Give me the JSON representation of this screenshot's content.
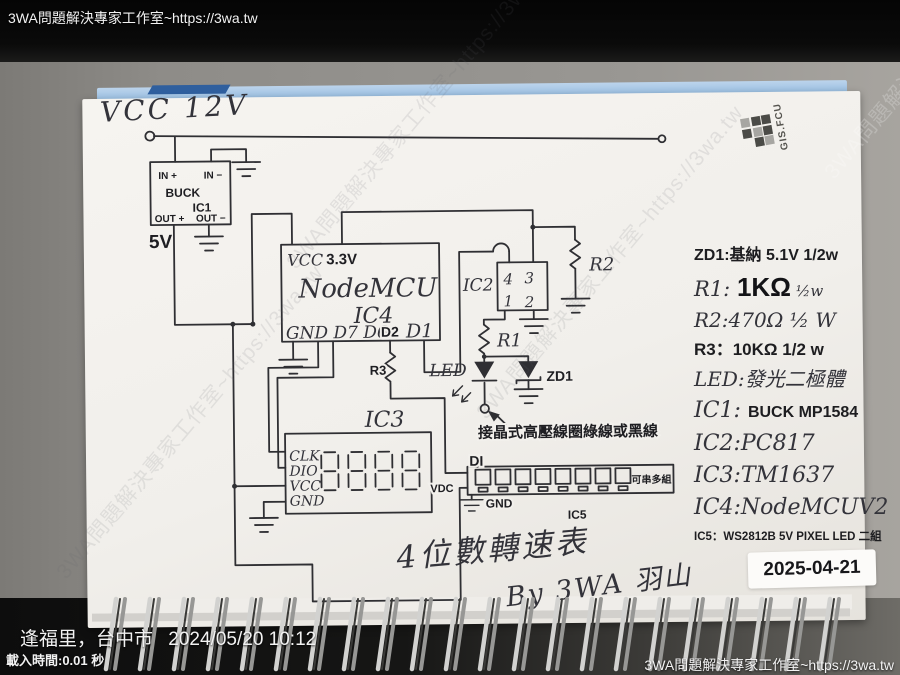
{
  "overlay": {
    "top_left": "3WA問題解決專家工作室~https://3wa.tw",
    "watermark": "3WA問題解決專家工作室~https://3wa.tw",
    "location": "逢福里，台中市",
    "datetime": "2024/05/20 10:12",
    "load_time": "載入時間:0.01 秒",
    "bottom_right": "3WA問題解決專家工作室~https://3wa.tw"
  },
  "page": {
    "logo_text": "GIS.FCU",
    "title": "4位數轉速表",
    "byline": "By 3WA 羽山",
    "date_label": "2025-04-21"
  },
  "schematic": {
    "vcc12_label": "VCC 12V",
    "v5_label": "5V",
    "ic1": {
      "in_p": "IN +",
      "in_m": "IN −",
      "name": "BUCK",
      "ref": "IC1",
      "out_p": "OUT +",
      "out_m": "OUT −"
    },
    "ic4": {
      "vcc": "VCC",
      "v33": "3.3V",
      "name": "NodeMCU",
      "ref": "IC4",
      "gnd_row": "GND D7 D6",
      "d2": "D2",
      "d1": "D1"
    },
    "ic2": {
      "ref": "IC2",
      "p4": "4",
      "p3": "3",
      "p1": "1",
      "p2": "2"
    },
    "r1": "R1",
    "r2": "R2",
    "r3": "R3",
    "led_label": "LED",
    "zd1_label": "ZD1",
    "coil_note": "接晶式高壓線圈綠線或黑線",
    "ic3": {
      "ref": "IC3",
      "pin_clk": "CLK",
      "pin_dio": "DIO",
      "pin_vcc": "VCC",
      "pin_gnd": "GND"
    },
    "ic5": {
      "di": "DI",
      "vdc": "VDC",
      "gnd": "GND",
      "ref": "IC5",
      "chain_note": "可串多組",
      "led_count": 8
    }
  },
  "notes": [
    {
      "segments": [
        {
          "t": "ZD1:基納 5.1V 1/2w",
          "s": "print16"
        }
      ]
    },
    {
      "segments": [
        {
          "t": "R1: ",
          "s": "hand21"
        },
        {
          "t": "1KΩ",
          "s": "big"
        },
        {
          "t": " ½w",
          "s": "hand15"
        }
      ]
    },
    {
      "segments": [
        {
          "t": "R2:470Ω ½ W",
          "s": "hand20"
        }
      ]
    },
    {
      "segments": [
        {
          "t": "R3：10KΩ 1/2 w",
          "s": "print17"
        }
      ]
    },
    {
      "segments": [
        {
          "t": "LED:發光二極體",
          "s": "hand20"
        }
      ]
    },
    {
      "segments": [
        {
          "t": "IC1: ",
          "s": "hand22"
        },
        {
          "t": "BUCK MP1584",
          "s": "print16"
        }
      ]
    },
    {
      "segments": [
        {
          "t": "IC2:PC817",
          "s": "hand22"
        }
      ]
    },
    {
      "segments": [
        {
          "t": "IC3:TM1637",
          "s": "hand22"
        }
      ]
    },
    {
      "segments": [
        {
          "t": "IC4:NodeMCUV2",
          "s": "hand22"
        }
      ]
    },
    {
      "segments": [
        {
          "t": "IC5：WS2812B 5V PIXEL LED 二組",
          "s": "print12"
        }
      ]
    }
  ],
  "colors": {
    "folder_blue": "#9cc0e2",
    "folder_tab_blue": "#2f5f9e",
    "page_white": "#f2f0ec",
    "ink": "#2f2f33",
    "desk_gray": "#8e8c88"
  }
}
